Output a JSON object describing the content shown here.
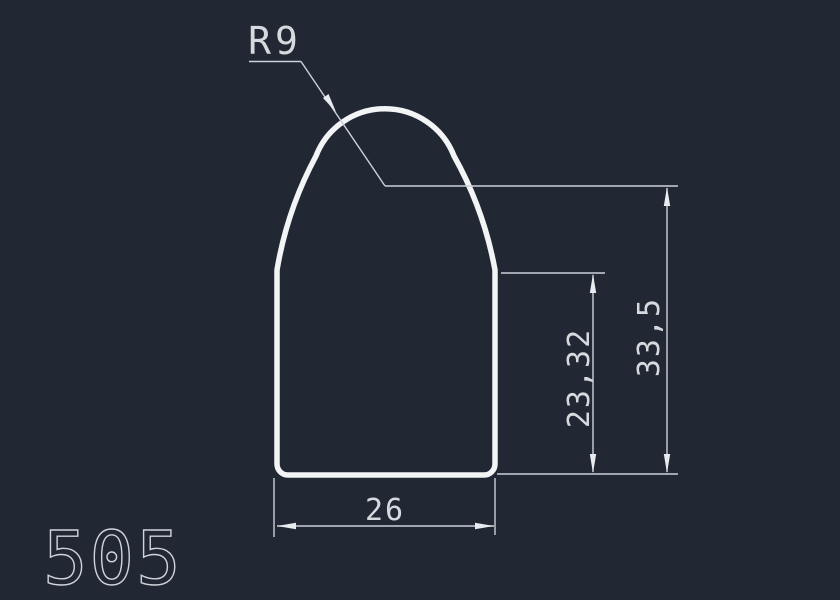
{
  "drawing": {
    "number": "505",
    "dimensions": {
      "radius": "R9",
      "width": "26",
      "shoulder_height": "23,32",
      "total_height": "33,5"
    },
    "colors": {
      "background": "#212733",
      "profile_line": "#f2f4f5",
      "dimension_line": "#ccd2d9",
      "dimension_text": "#d5dade"
    }
  }
}
